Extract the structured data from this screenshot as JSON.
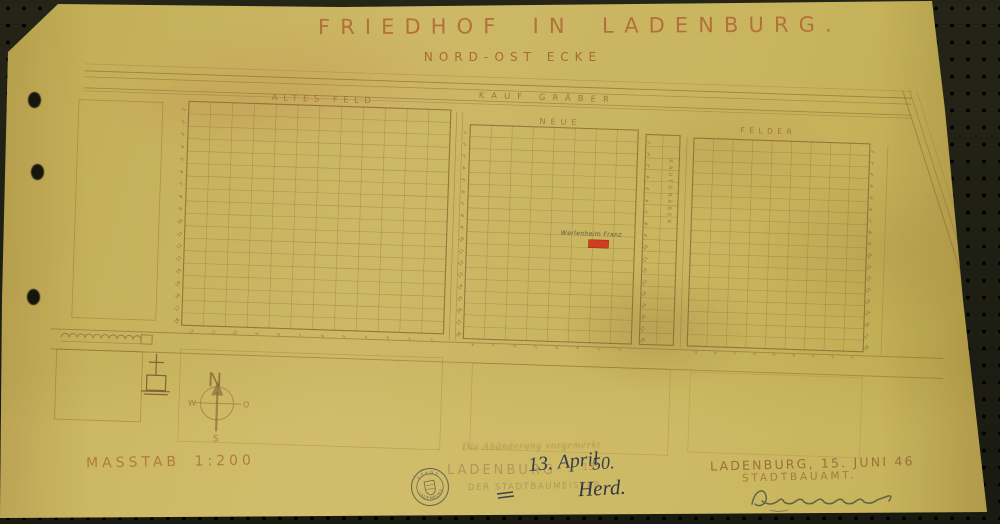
{
  "document": {
    "title": "FRIEDHOF IN LADENBURG.",
    "subtitle": "NORD-OST ECKE"
  },
  "plan": {
    "top_band_label": "KAUF GRÄBER",
    "grids": [
      {
        "id": "altes-feld",
        "label": "ALTES FELD",
        "rows": 18,
        "cols": 12
      },
      {
        "id": "neue",
        "label": "NEUE",
        "rows": 18,
        "cols": 8
      },
      {
        "id": "kaufgraeber-strip",
        "label": "KAUFGRÄBER",
        "rows": 18,
        "cols": 2
      },
      {
        "id": "felder",
        "label": "FELDER",
        "rows": 18,
        "cols": 9
      }
    ],
    "compass": {
      "north": "N",
      "east": "O",
      "south": "S",
      "west": "W"
    },
    "red_plot": {
      "color": "#cf3f1f",
      "note": "Werlenheim Franz"
    }
  },
  "annotations": {
    "scale_label": "MASSTAB 1:200",
    "faint_note": "Die Abänderung vorgemerkt",
    "stamp": {
      "arc_top": "STADT",
      "arc_bottom": "LADENBURG"
    },
    "approval_center": {
      "place": "LADENBURG",
      "date": "13. April",
      "year_preprint": "19",
      "year": "50.",
      "office": "DER STADTBAUMEISTER",
      "signature": "Herd."
    },
    "approval_right": {
      "line1": "LADENBURG, 15. JUNI 46",
      "line2": "STADTBAUAMT."
    }
  },
  "colors": {
    "paper": "#c8b45c",
    "ink_sepia": "#8a6134",
    "ink_dark": "#3a4250",
    "ink_green": "#4a5843",
    "red_plot": "#cf3f1f",
    "stamp_ink": "#575c4e"
  }
}
